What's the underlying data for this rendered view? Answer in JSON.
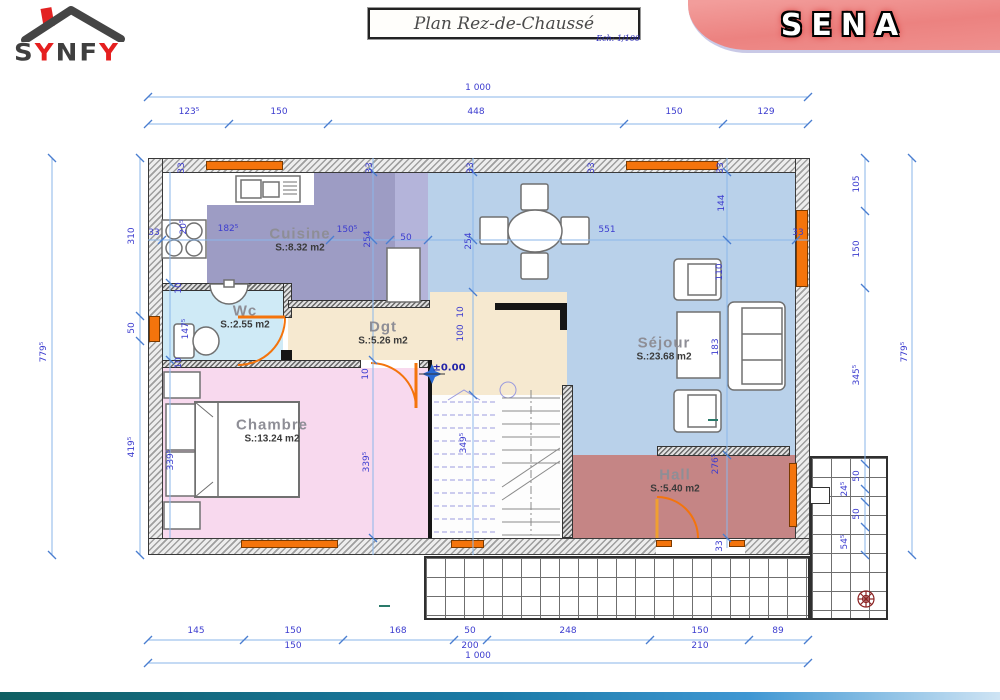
{
  "header": {
    "logo_letters": [
      {
        "t": "S",
        "color": "#3f3f3f"
      },
      {
        "t": "Y",
        "color": "#e51f1f"
      },
      {
        "t": "N",
        "color": "#3f3f3f"
      },
      {
        "t": "F",
        "color": "#3f3f3f"
      },
      {
        "t": "Y",
        "color": "#e51f1f"
      }
    ],
    "title": "Plan Rez-de-Chaussé",
    "scale_note": "Ech: 1/100",
    "banner_text": "SENA",
    "banner_color": "#ec8280",
    "accent_red": "#e51f1f"
  },
  "plan": {
    "level_marker": "±0.00",
    "window_color": "#f4740c",
    "dim_line_color": "#8ab6ea",
    "dim_text_color": "#3c3ccf",
    "rooms": [
      {
        "id": "cuisine",
        "name": "Cuisine",
        "area": "S.:8.32 m2",
        "color": "#9d9cc4",
        "x": 300,
        "y": 240
      },
      {
        "id": "wc",
        "name": "Wc",
        "area": "S.:2.55 m2",
        "color": "#cfeaf6",
        "x": 245,
        "y": 317
      },
      {
        "id": "dgt",
        "name": "Dgt",
        "area": "S.:5.26 m2",
        "color": "#f6e9d0",
        "x": 383,
        "y": 333
      },
      {
        "id": "chambre",
        "name": "Chambre",
        "area": "S.:13.24 m2",
        "color": "#f8d9ee",
        "x": 272,
        "y": 431
      },
      {
        "id": "sejour",
        "name": "Séjour",
        "area": "S.:23.68 m2",
        "color": "#b9d1ea",
        "x": 664,
        "y": 349
      },
      {
        "id": "hall",
        "name": "Hall",
        "area": "S.:5.40 m2",
        "color": "#c58585",
        "x": 675,
        "y": 481
      }
    ],
    "dims": [
      {
        "t": "1 000",
        "x": 478,
        "y": 88
      },
      {
        "t": "123⁵",
        "x": 189,
        "y": 112
      },
      {
        "t": "150",
        "x": 279,
        "y": 112
      },
      {
        "t": "448",
        "x": 476,
        "y": 112
      },
      {
        "t": "150",
        "x": 674,
        "y": 112
      },
      {
        "t": "129",
        "x": 766,
        "y": 112
      },
      {
        "t": "779⁵",
        "x": 44,
        "y": 352,
        "r": 1
      },
      {
        "t": "310",
        "x": 132,
        "y": 236,
        "r": 1
      },
      {
        "t": "50",
        "x": 132,
        "y": 328,
        "r": 1
      },
      {
        "t": "419⁵",
        "x": 132,
        "y": 447,
        "r": 1
      },
      {
        "t": "105",
        "x": 857,
        "y": 184,
        "r": 1
      },
      {
        "t": "150",
        "x": 857,
        "y": 249,
        "r": 1
      },
      {
        "t": "345⁵",
        "x": 857,
        "y": 375,
        "r": 1
      },
      {
        "t": "50",
        "x": 857,
        "y": 476,
        "r": 1
      },
      {
        "t": "24⁵",
        "x": 845,
        "y": 489,
        "r": 1
      },
      {
        "t": "50",
        "x": 857,
        "y": 514,
        "r": 1
      },
      {
        "t": "54⁵",
        "x": 845,
        "y": 542,
        "r": 1
      },
      {
        "t": "779⁵",
        "x": 905,
        "y": 352,
        "r": 1
      },
      {
        "t": "145",
        "x": 196,
        "y": 631
      },
      {
        "t": "150",
        "x": 293,
        "y": 631
      },
      {
        "t": "168",
        "x": 398,
        "y": 631
      },
      {
        "t": "50",
        "x": 470,
        "y": 631
      },
      {
        "t": "248",
        "x": 568,
        "y": 631
      },
      {
        "t": "150",
        "x": 700,
        "y": 631
      },
      {
        "t": "89",
        "x": 778,
        "y": 631
      },
      {
        "t": "150",
        "x": 293,
        "y": 646
      },
      {
        "t": "200",
        "x": 470,
        "y": 646
      },
      {
        "t": "210",
        "x": 700,
        "y": 646
      },
      {
        "t": "1 000",
        "x": 478,
        "y": 656
      },
      {
        "t": "33",
        "x": 154,
        "y": 233
      },
      {
        "t": "182⁵",
        "x": 228,
        "y": 229
      },
      {
        "t": "150⁵",
        "x": 347,
        "y": 230
      },
      {
        "t": "50",
        "x": 406,
        "y": 238
      },
      {
        "t": "551",
        "x": 607,
        "y": 230
      },
      {
        "t": "33",
        "x": 798,
        "y": 233
      },
      {
        "t": "254",
        "x": 368,
        "y": 239,
        "r": 1
      },
      {
        "t": "254",
        "x": 469,
        "y": 241,
        "r": 1
      },
      {
        "t": "144",
        "x": 722,
        "y": 203,
        "r": 1
      },
      {
        "t": "110",
        "x": 720,
        "y": 272,
        "r": 1
      },
      {
        "t": "183",
        "x": 716,
        "y": 347,
        "r": 1
      },
      {
        "t": "276⁵",
        "x": 716,
        "y": 464,
        "r": 1
      },
      {
        "t": "20⁵",
        "x": 184,
        "y": 227,
        "r": 1
      },
      {
        "t": "10",
        "x": 179,
        "y": 288,
        "r": 1
      },
      {
        "t": "147⁵",
        "x": 186,
        "y": 329,
        "r": 1
      },
      {
        "t": "10",
        "x": 179,
        "y": 363,
        "r": 1
      },
      {
        "t": "10",
        "x": 366,
        "y": 374,
        "r": 1
      },
      {
        "t": "10",
        "x": 461,
        "y": 312,
        "r": 1
      },
      {
        "t": "100",
        "x": 461,
        "y": 333,
        "r": 1
      },
      {
        "t": "349⁵",
        "x": 464,
        "y": 443,
        "r": 1
      },
      {
        "t": "339⁵",
        "x": 171,
        "y": 460,
        "r": 1
      },
      {
        "t": "339⁵",
        "x": 367,
        "y": 462,
        "r": 1
      },
      {
        "t": "33",
        "x": 720,
        "y": 546,
        "r": 1
      },
      {
        "t": "33",
        "x": 182,
        "y": 168,
        "r": 1
      },
      {
        "t": "33",
        "x": 370,
        "y": 168,
        "r": 1
      },
      {
        "t": "33",
        "x": 471,
        "y": 168,
        "r": 1
      },
      {
        "t": "33",
        "x": 592,
        "y": 168,
        "r": 1
      },
      {
        "t": "33",
        "x": 721,
        "y": 168,
        "r": 1
      }
    ]
  }
}
